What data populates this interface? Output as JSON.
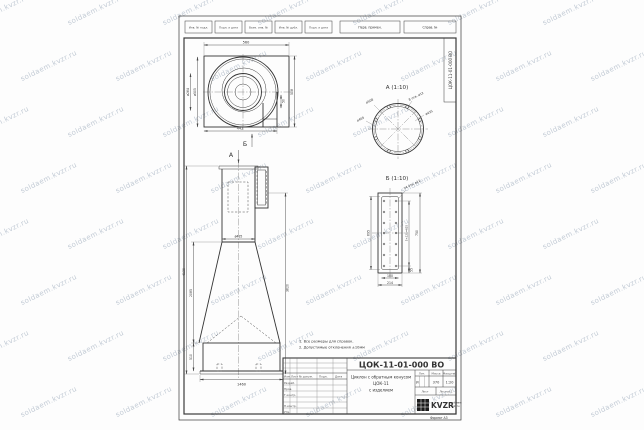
{
  "watermark": {
    "text": "soldaem.kvzr.ru"
  },
  "stamp_top": {
    "boxes": [
      "Инв. № подл.",
      "Подп. и дата",
      "Взам. инв. №",
      "Инв. № дубл.",
      "Подп. и дата"
    ],
    "right_boxes": [
      "Перв. примен.",
      "Справ. №"
    ]
  },
  "notes": [
    "1. Все размеры для справок.",
    "2. Допустимые отклонения ±10мм"
  ],
  "views": {
    "top_view": {
      "marker": "Б",
      "dims": {
        "top": "560",
        "bottom": "442",
        "right": "508",
        "gap": "50",
        "d_inner": "ø264",
        "d_outer": "ø505"
      }
    },
    "front_view": {
      "marker": "А",
      "dims": {
        "total": "4130",
        "cone": "2085",
        "base_h": "510",
        "base_w": "1460",
        "cyl": "ø435",
        "right": "3620"
      }
    },
    "view_a": {
      "title": "А (1:10)",
      "holes": "8 отв. ø12",
      "d1": "ø508",
      "d2": "ø465",
      "d3": "ø435"
    },
    "view_b": {
      "title": "Б (1:10)",
      "holes": "14 отв. ø12",
      "left": "695",
      "pitch": "5×125=625",
      "right": "750",
      "small": "55",
      "b1": "180",
      "b2": "214"
    }
  },
  "title_block": {
    "doc_number": "ЦОК-11-01-000 ВО",
    "name1": "Циклон с обратным конусом",
    "name2": "ЦОК-11",
    "name3": "с изделием",
    "left_headers": [
      "Изм.",
      "Лист",
      "№ докум.",
      "Подп.",
      "Дата"
    ],
    "rows": [
      "Разраб.",
      "Пров.",
      "Т.контр.",
      "Н.контр.",
      "Утв."
    ],
    "headers": {
      "lit": "Лит.",
      "mass": "Масса",
      "scale": "Масштаб"
    },
    "values": {
      "lit": "И",
      "mass": "370",
      "scale": "1:20"
    },
    "sheet": {
      "list": "Лист",
      "listov": "Листов 1"
    },
    "logo": "KVZR",
    "logo_sub1": "soldaem",
    "logo_sub2": "kvzr.ru",
    "format": "Формат А3"
  }
}
